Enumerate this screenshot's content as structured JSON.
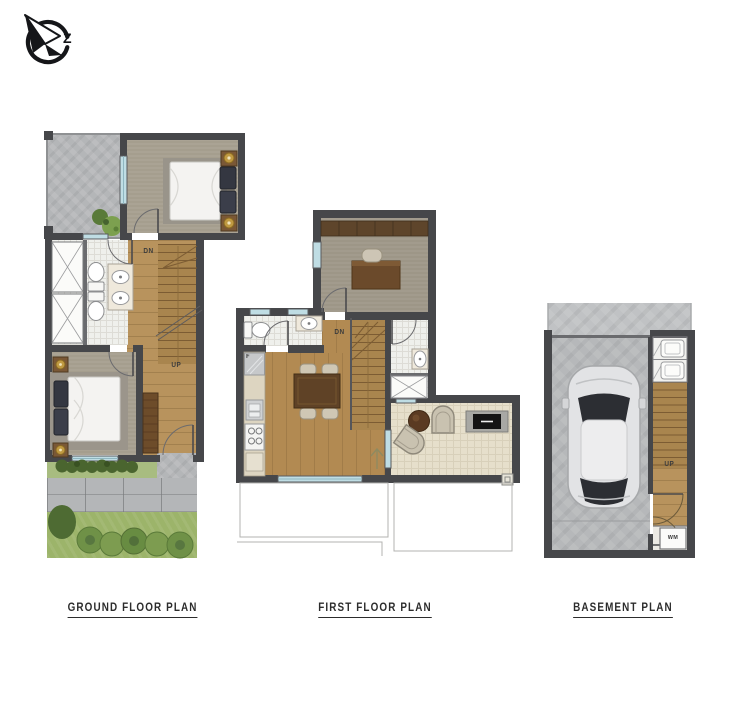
{
  "compass": {
    "direction_letter": "Z"
  },
  "captions": {
    "ground": "GROUND FLOOR PLAN",
    "first": "FIRST FLOOR PLAN",
    "basement": "BASEMENT PLAN"
  },
  "stair_labels": {
    "ground_down": "DN",
    "ground_up": "UP",
    "first_down": "DN",
    "basement_up": "UP"
  },
  "appliance_labels": {
    "fridge": "F",
    "washing_machine": "WM"
  },
  "colors": {
    "wall": "#46474a",
    "wood_floor": "#b8935d",
    "stair_wood": "#a9854e",
    "carpet": "#a59e8e",
    "bathroom_tile": "#eff0ec",
    "living_tile": "#e6dfcb",
    "stone": "#b4b6b8",
    "grass": "#9cb46a",
    "tree_green": "#6f9147",
    "window_glass": "#bfdde4",
    "furniture_dark_wood": "#5f4226",
    "cushion_dark": "#343741",
    "lamp_gold": "#c09a42"
  }
}
